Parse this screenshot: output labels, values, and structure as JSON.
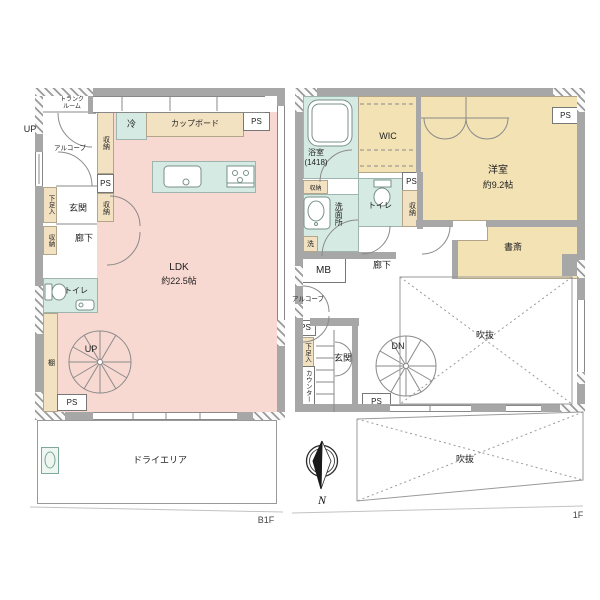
{
  "colors": {
    "room_pink": "#f8d9d2",
    "wet_teal": "#d6eae4",
    "storage_tan": "#f3e2c2",
    "room_tan": "#f2e2b4",
    "wall_gray": "#a7a7a7"
  },
  "shared": {
    "ps": "PS",
    "storage": "収納",
    "up": "UP",
    "dn": "DN",
    "void": "吹抜",
    "toilet": "トイレ",
    "entrance": "玄関",
    "hallway": "廊下",
    "alcove": "アルコーブ",
    "shoe_cabinet": "下足入",
    "north": "N"
  },
  "b1f": {
    "floor_label": "B1F",
    "trunk_room": "トランクルーム",
    "refrigerator": "冷",
    "cupboard": "カップボード",
    "shelf": "棚",
    "ldk_name": "LDK",
    "ldk_size": "約22.5帖",
    "dry_area": "ドライエリア"
  },
  "f1": {
    "floor_label": "1F",
    "bath_name": "浴室",
    "bath_size": "(1418)",
    "wic": "WIC",
    "western_name": "洋室",
    "western_size": "約9.2帖",
    "washroom": "洗面所",
    "laundry": "洗",
    "meter_box": "MB",
    "study": "書斎",
    "counter": "カウンター"
  }
}
